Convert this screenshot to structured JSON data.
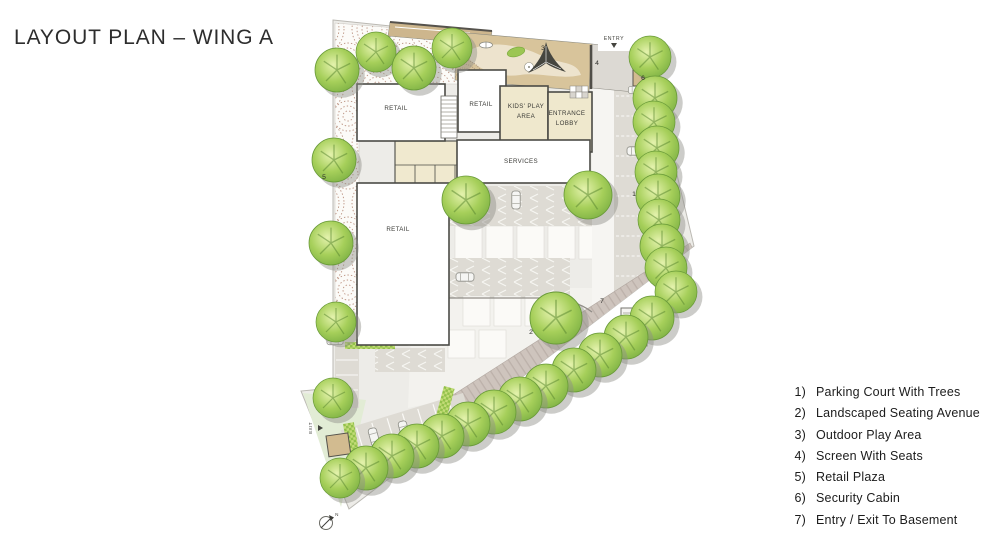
{
  "title": "LAYOUT PLAN – WING A",
  "legend": [
    {
      "num": "1)",
      "label": "Parking Court With Trees"
    },
    {
      "num": "2)",
      "label": "Landscaped Seating Avenue"
    },
    {
      "num": "3)",
      "label": "Outdoor Play Area"
    },
    {
      "num": "4)",
      "label": "Screen With Seats"
    },
    {
      "num": "5)",
      "label": "Retail Plaza"
    },
    {
      "num": "6)",
      "label": "Security Cabin"
    },
    {
      "num": "7)",
      "label": "Entry / Exit To Basement"
    }
  ],
  "plan": {
    "buildings": {
      "retail_top": "RETAIL",
      "retail_upper": "RETAIL",
      "retail_main": "RETAIL",
      "kids_play_1": "KIDS' PLAY",
      "kids_play_2": "AREA",
      "entrance_1": "ENTRANCE",
      "entrance_2": "LOBBY",
      "services": "SERVICES"
    },
    "labels": {
      "entry": "ENTRY",
      "exit": "EXIT",
      "north": "N"
    },
    "markers": {
      "m1": "1",
      "m2": "2",
      "m3": "3",
      "m4": "4",
      "m5": "5",
      "m6": "6",
      "m7": "7"
    },
    "colors": {
      "tree_green": "#8dc63f",
      "ground": "#edece8",
      "play_tan": "#d8c49b",
      "avenue": "#cec4bd",
      "paving_dots": "#ba9180",
      "grass": "#a5cd4e",
      "cabin_tan": "#d2bb90"
    }
  }
}
